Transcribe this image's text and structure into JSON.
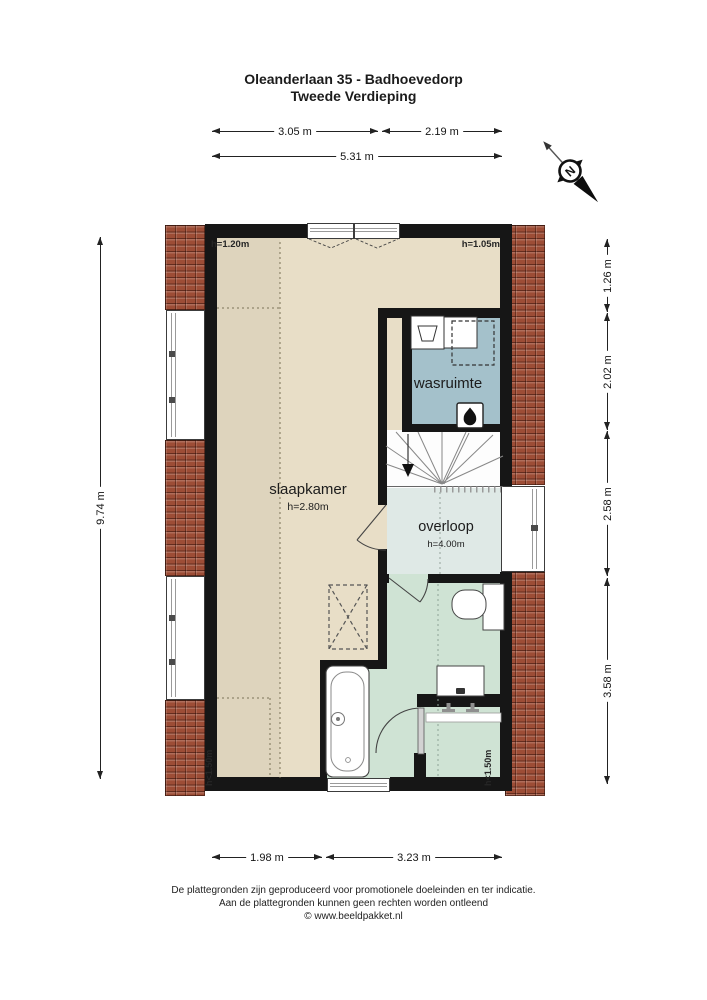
{
  "title": {
    "line1": "Oleanderlaan 35 - Badhoevedorp",
    "line2": "Tweede Verdieping"
  },
  "palette": {
    "wall": "#161616",
    "bedroom": "#e8dec7",
    "laundry": "#a4c1cb",
    "landing": "#dfe9e6",
    "bath": "#cfe3d4",
    "stairs": "#fdfdfd",
    "roof": "#9d4d36",
    "dim": "#1c1c1c"
  },
  "rooms": {
    "slaapkamer": {
      "label": "slaapkamer",
      "height": "h=2.80m"
    },
    "wasruimte": {
      "label": "wasruimte"
    },
    "overloop": {
      "label": "overloop",
      "height": "h=4.00m"
    }
  },
  "height_notes": {
    "top_left": "h=1.20m",
    "top_right": "h=1.05m",
    "bottom_left": "h<1.50m",
    "bottom_right": "h<1.50m"
  },
  "dimensions": {
    "top_row": [
      {
        "label": "3.05 m"
      },
      {
        "label": "2.19 m"
      }
    ],
    "top_total": {
      "label": "5.31 m"
    },
    "left_total": {
      "label": "9.74 m"
    },
    "right_column": [
      {
        "label": "1.26 m"
      },
      {
        "label": "2.02 m"
      },
      {
        "label": "2.58 m"
      },
      {
        "label": "3.58 m"
      }
    ],
    "bottom_row": [
      {
        "label": "1.98 m"
      },
      {
        "label": "3.23 m"
      }
    ]
  },
  "compass": {
    "north_label": "N"
  },
  "icons": {
    "compass": "north-arrow-icon",
    "boiler": "flame-icon",
    "stairs_direction": "down-arrow-icon",
    "washer": "basin-icon"
  },
  "footer": {
    "line1": "De plattegronden zijn geproduceerd voor promotionele doeleinden en ter indicatie.",
    "line2": "Aan de plattegronden kunnen geen rechten worden ontleend",
    "line3": "© www.beeldpakket.nl"
  }
}
